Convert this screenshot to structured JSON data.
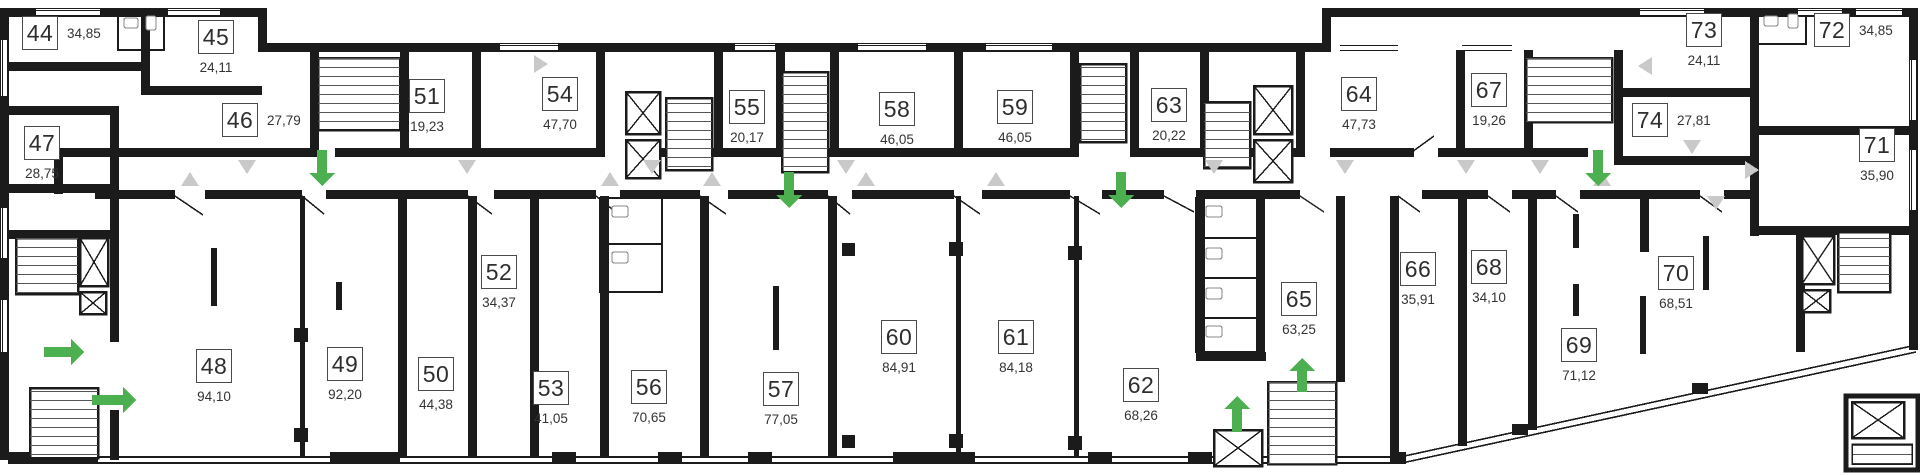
{
  "floor_plan": {
    "colors": {
      "walls": "#1b1b1b",
      "entrance_arrow": "#4caf50",
      "door_swing": "#c9c9c9"
    },
    "units": [
      {
        "number": "44",
        "area": "34,85"
      },
      {
        "number": "45",
        "area": "24,11"
      },
      {
        "number": "46",
        "area": "27,79"
      },
      {
        "number": "47",
        "area": "28,75"
      },
      {
        "number": "48",
        "area": "94,10"
      },
      {
        "number": "49",
        "area": "92,20"
      },
      {
        "number": "50",
        "area": "44,38"
      },
      {
        "number": "51",
        "area": "19,23"
      },
      {
        "number": "52",
        "area": "34,37"
      },
      {
        "number": "53",
        "area": "41,05"
      },
      {
        "number": "54",
        "area": "47,70"
      },
      {
        "number": "55",
        "area": "20,17"
      },
      {
        "number": "56",
        "area": "70,65"
      },
      {
        "number": "57",
        "area": "77,05"
      },
      {
        "number": "58",
        "area": "46,05"
      },
      {
        "number": "59",
        "area": "46,05"
      },
      {
        "number": "60",
        "area": "84,91"
      },
      {
        "number": "61",
        "area": "84,18"
      },
      {
        "number": "62",
        "area": "68,26"
      },
      {
        "number": "63",
        "area": "20,22"
      },
      {
        "number": "64",
        "area": "47,73"
      },
      {
        "number": "65",
        "area": "63,25"
      },
      {
        "number": "66",
        "area": "35,91"
      },
      {
        "number": "67",
        "area": "19,26"
      },
      {
        "number": "68",
        "area": "34,10"
      },
      {
        "number": "69",
        "area": "71,12"
      },
      {
        "number": "70",
        "area": "68,51"
      },
      {
        "number": "71",
        "area": "35,90"
      },
      {
        "number": "72",
        "area": "34,85"
      },
      {
        "number": "73",
        "area": "24,11"
      },
      {
        "number": "74",
        "area": "27,81"
      }
    ]
  }
}
